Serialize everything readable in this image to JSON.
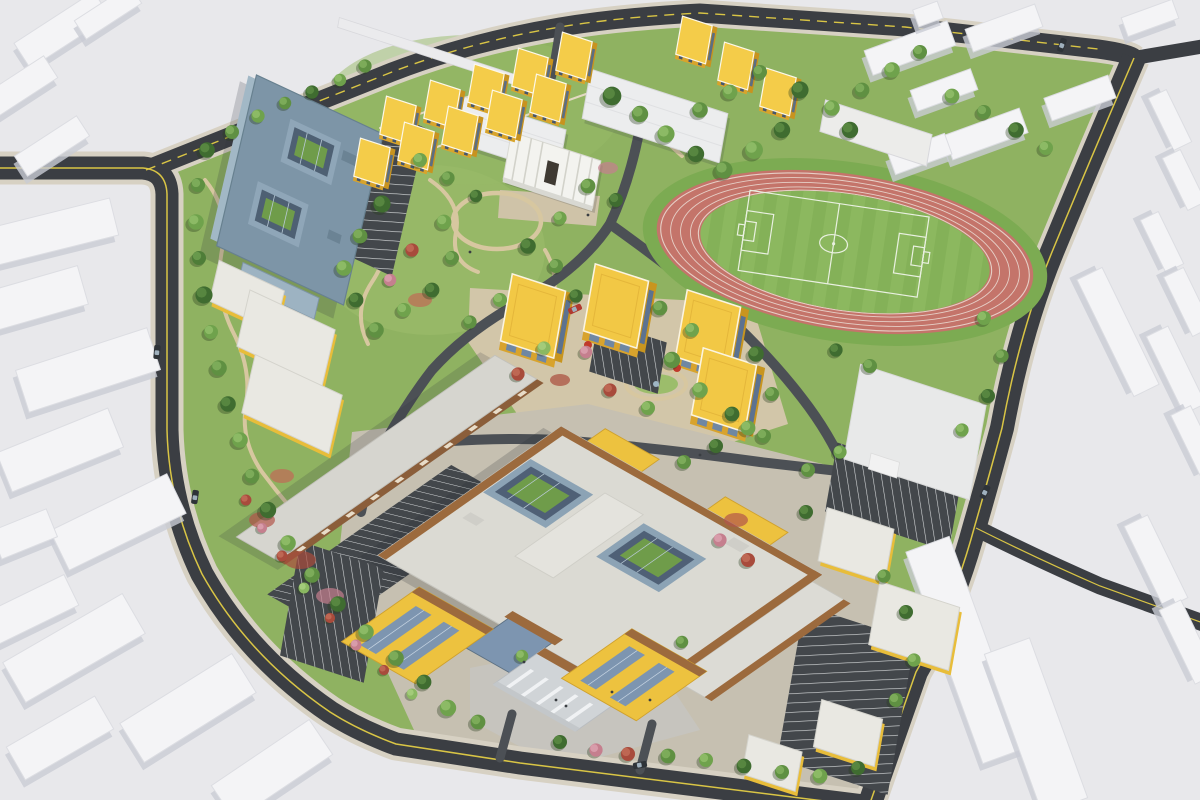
{
  "palette": {
    "background": "#e8e8eb",
    "context_building": "#f4f4f6",
    "context_shadow": "#c9ccd4",
    "context_stroke": "#dcdde2",
    "road": "#3b3e43",
    "road_inner": "#4c5055",
    "sidewalk": "#d7d1c3",
    "lane_yellow": "#d9c545",
    "stripe_white": "#dadde0",
    "campus_lawn": "#8fb261",
    "lawn_light": "#9cbd6b",
    "paving_tan": "#d2c6a9",
    "paving_gray": "#c6c0b1",
    "garden_path": "#d7c7a0",
    "track_surface": "#c4746a",
    "track_line": "#ecdfd7",
    "field_green": "#84b158",
    "field_stripe": "#93bf66",
    "field_line": "#e9f0e0",
    "asphalt": "#43474b",
    "dorm_roof": "#f4cc49",
    "dorm_side": "#d8a42c",
    "dorm_window": "#46566b",
    "cube_roof": "#f2c845",
    "glass_blue": "#7d95b0",
    "glass_dark": "#51637a",
    "blue_roof": "#7d95a7",
    "blue_roof_edge": "#67808f",
    "main_roof": "#dbdad3",
    "wood_trim": "#9c6a3d",
    "yellow_wall": "#edc23f",
    "yellow_shadow": "#cfa12e",
    "stone": "#d0d4d7",
    "white_roof": "#ececea",
    "brown_facade": "#8b5e3a",
    "courtyard_lawn": "#6f9c4a",
    "car_dark": "#2e3338",
    "car_red": "#b03a30",
    "tree_greens": [
      "#4e7d38",
      "#5f9042",
      "#6fa24c",
      "#3f6c30"
    ],
    "shrub_red": "#a84b3c",
    "shrub_pink": "#c57f8e"
  },
  "scene": {
    "context_buildings": [
      [
        62,
        30,
        95,
        30,
        -33
      ],
      [
        18,
        88,
        78,
        26,
        -33
      ],
      [
        108,
        12,
        66,
        22,
        -33
      ],
      [
        52,
        146,
        74,
        24,
        -33
      ],
      [
        52,
        232,
        128,
        38,
        -14
      ],
      [
        30,
        300,
        110,
        40,
        -16
      ],
      [
        88,
        370,
        138,
        44,
        -18
      ],
      [
        60,
        450,
        120,
        42,
        -22
      ],
      [
        118,
        522,
        130,
        44,
        -26
      ],
      [
        24,
        534,
        60,
        30,
        -22
      ],
      [
        30,
        610,
        92,
        34,
        -26
      ],
      [
        74,
        648,
        138,
        46,
        -30
      ],
      [
        188,
        708,
        132,
        46,
        -32
      ],
      [
        60,
        738,
        102,
        38,
        -30
      ],
      [
        272,
        770,
        118,
        42,
        -34
      ],
      [
        910,
        48,
        88,
        26,
        -20
      ],
      [
        1004,
        28,
        74,
        24,
        -20
      ],
      [
        944,
        90,
        64,
        22,
        -20
      ],
      [
        1080,
        98,
        68,
        24,
        -20
      ],
      [
        986,
        134,
        80,
        26,
        -20
      ],
      [
        920,
        154,
        60,
        22,
        -20
      ],
      [
        1150,
        18,
        54,
        20,
        -20
      ],
      [
        928,
        14,
        26,
        18,
        -20
      ],
      [
        1170,
        120,
        58,
        20,
        64
      ],
      [
        1184,
        180,
        58,
        20,
        64
      ],
      [
        1162,
        242,
        58,
        20,
        64
      ],
      [
        1188,
        302,
        66,
        22,
        64
      ],
      [
        1176,
        370,
        86,
        24,
        64
      ],
      [
        1196,
        442,
        70,
        22,
        64
      ],
      [
        966,
        650,
        46,
        225,
        -20
      ],
      [
        1036,
        726,
        48,
        170,
        -20
      ],
      [
        1118,
        332,
        130,
        28,
        64
      ],
      [
        1156,
        562,
        92,
        26,
        64
      ],
      [
        1188,
        642,
        82,
        24,
        64
      ]
    ],
    "dorm_cubes": [
      [
        398,
        120
      ],
      [
        442,
        104
      ],
      [
        486,
        88
      ],
      [
        530,
        72
      ],
      [
        574,
        56
      ],
      [
        372,
        162
      ],
      [
        416,
        146
      ],
      [
        460,
        130
      ],
      [
        504,
        114
      ],
      [
        548,
        98
      ],
      [
        694,
        40
      ],
      [
        736,
        66
      ],
      [
        778,
        92
      ]
    ],
    "teaching_cubes": [
      [
        533,
        316
      ],
      [
        616,
        306
      ],
      [
        708,
        332
      ],
      [
        724,
        390
      ]
    ],
    "trees": [
      [
        207,
        150,
        1,
        3
      ],
      [
        198,
        185,
        0.9,
        1
      ],
      [
        196,
        222,
        1,
        2
      ],
      [
        199,
        258,
        0.9,
        0
      ],
      [
        204,
        295,
        1.1,
        3
      ],
      [
        211,
        332,
        0.9,
        2
      ],
      [
        219,
        368,
        1,
        1
      ],
      [
        228,
        404,
        1,
        3
      ],
      [
        240,
        440,
        1,
        2
      ],
      [
        252,
        476,
        0.95,
        1
      ],
      [
        268,
        510,
        1.05,
        3
      ],
      [
        288,
        543,
        1,
        2
      ],
      [
        312,
        575,
        1,
        1
      ],
      [
        338,
        604,
        1,
        3
      ],
      [
        366,
        632,
        1,
        2
      ],
      [
        396,
        658,
        1,
        1
      ],
      [
        424,
        682,
        0.95,
        3
      ],
      [
        246,
        500,
        0.7,
        4
      ],
      [
        262,
        528,
        0.65,
        5
      ],
      [
        282,
        556,
        0.7,
        4
      ],
      [
        304,
        588,
        0.7,
        6
      ],
      [
        330,
        618,
        0.65,
        4
      ],
      [
        356,
        645,
        0.7,
        5
      ],
      [
        384,
        670,
        0.65,
        4
      ],
      [
        412,
        694,
        0.7,
        6
      ],
      [
        232,
        132,
        0.9,
        1
      ],
      [
        258,
        116,
        0.85,
        2
      ],
      [
        285,
        103,
        0.8,
        1
      ],
      [
        312,
        92,
        0.85,
        3
      ],
      [
        340,
        80,
        0.8,
        2
      ],
      [
        365,
        66,
        0.85,
        1
      ],
      [
        420,
        160,
        0.9,
        2
      ],
      [
        448,
        178,
        0.85,
        1
      ],
      [
        476,
        196,
        0.8,
        3
      ],
      [
        588,
        186,
        0.95,
        1
      ],
      [
        616,
        200,
        0.9,
        3
      ],
      [
        560,
        218,
        0.85,
        2
      ],
      [
        612,
        96,
        1.2,
        3
      ],
      [
        640,
        114,
        1.05,
        1
      ],
      [
        666,
        134,
        1.1,
        2
      ],
      [
        696,
        154,
        1.05,
        3
      ],
      [
        724,
        170,
        1.1,
        1
      ],
      [
        754,
        150,
        1.15,
        2
      ],
      [
        782,
        130,
        1.05,
        3
      ],
      [
        700,
        110,
        1,
        1
      ],
      [
        730,
        92,
        0.95,
        2
      ],
      [
        760,
        72,
        0.9,
        1
      ],
      [
        800,
        90,
        1.1,
        3
      ],
      [
        832,
        108,
        1,
        2
      ],
      [
        862,
        90,
        0.95,
        1
      ],
      [
        892,
        70,
        1,
        2
      ],
      [
        920,
        52,
        0.9,
        1
      ],
      [
        850,
        130,
        1.05,
        3
      ],
      [
        952,
        96,
        0.95,
        2
      ],
      [
        984,
        112,
        0.9,
        1
      ],
      [
        1016,
        130,
        1,
        3
      ],
      [
        1046,
        148,
        0.9,
        2
      ],
      [
        672,
        360,
        1.05,
        1
      ],
      [
        700,
        390,
        1,
        2
      ],
      [
        732,
        414,
        0.95,
        3
      ],
      [
        764,
        436,
        0.9,
        1
      ],
      [
        984,
        318,
        0.9,
        2
      ],
      [
        1002,
        356,
        0.85,
        1
      ],
      [
        988,
        396,
        0.9,
        3
      ],
      [
        962,
        430,
        0.85,
        2
      ],
      [
        870,
        366,
        0.9,
        1
      ],
      [
        836,
        350,
        0.85,
        3
      ],
      [
        382,
        204,
        1.1,
        3
      ],
      [
        360,
        236,
        0.95,
        1
      ],
      [
        344,
        268,
        1,
        2
      ],
      [
        356,
        300,
        0.95,
        3
      ],
      [
        376,
        330,
        1,
        1
      ],
      [
        404,
        310,
        0.9,
        2
      ],
      [
        432,
        290,
        0.95,
        3
      ],
      [
        452,
        258,
        0.9,
        1
      ],
      [
        444,
        222,
        0.95,
        2
      ],
      [
        412,
        250,
        0.85,
        4
      ],
      [
        390,
        280,
        0.8,
        5
      ],
      [
        528,
        246,
        1,
        3
      ],
      [
        556,
        266,
        0.9,
        1
      ],
      [
        500,
        300,
        0.9,
        2
      ],
      [
        470,
        322,
        0.85,
        1
      ],
      [
        576,
        296,
        0.85,
        3
      ],
      [
        660,
        308,
        0.95,
        1
      ],
      [
        692,
        330,
        0.9,
        2
      ],
      [
        756,
        354,
        1,
        3
      ],
      [
        772,
        394,
        0.9,
        1
      ],
      [
        748,
        428,
        0.95,
        2
      ],
      [
        716,
        446,
        0.9,
        3
      ],
      [
        684,
        462,
        0.9,
        1
      ],
      [
        648,
        408,
        0.9,
        2
      ],
      [
        610,
        390,
        0.85,
        4
      ],
      [
        586,
        352,
        0.8,
        5
      ],
      [
        544,
        348,
        0.85,
        6
      ],
      [
        518,
        374,
        0.85,
        4
      ],
      [
        808,
        470,
        0.9,
        1
      ],
      [
        840,
        452,
        0.85,
        2
      ],
      [
        806,
        512,
        0.9,
        3
      ],
      [
        448,
        708,
        1.05,
        2
      ],
      [
        478,
        722,
        0.95,
        1
      ],
      [
        560,
        742,
        0.9,
        3
      ],
      [
        596,
        750,
        0.85,
        5
      ],
      [
        628,
        754,
        0.9,
        4
      ],
      [
        668,
        756,
        0.95,
        1
      ],
      [
        706,
        760,
        0.9,
        2
      ],
      [
        744,
        766,
        0.95,
        3
      ],
      [
        782,
        772,
        0.9,
        1
      ],
      [
        820,
        776,
        0.95,
        2
      ],
      [
        858,
        768,
        0.9,
        3
      ],
      [
        896,
        700,
        0.9,
        1
      ],
      [
        914,
        660,
        0.85,
        2
      ],
      [
        906,
        612,
        0.9,
        3
      ],
      [
        884,
        576,
        0.85,
        1
      ],
      [
        748,
        560,
        0.9,
        4
      ],
      [
        720,
        540,
        0.85,
        5
      ],
      [
        522,
        656,
        0.8,
        2
      ],
      [
        682,
        642,
        0.8,
        1
      ]
    ],
    "flower_beds": [
      [
        300,
        560,
        16,
        9,
        "#a84b3c"
      ],
      [
        330,
        596,
        14,
        8,
        "#c57f8e"
      ],
      [
        262,
        520,
        13,
        8,
        "#b2564a"
      ],
      [
        420,
        300,
        12,
        7,
        "#c06a55"
      ],
      [
        560,
        380,
        10,
        6,
        "#a84b3c"
      ],
      [
        736,
        520,
        12,
        7,
        "#b2564a"
      ],
      [
        608,
        168,
        10,
        6,
        "#c57f8e"
      ],
      [
        282,
        476,
        12,
        7,
        "#c06a55"
      ]
    ],
    "sculptures": [
      [
        588,
        345
      ],
      [
        677,
        368
      ]
    ],
    "cars": [
      [
        195,
        497,
        -82,
        "dark"
      ],
      [
        157,
        352,
        -85,
        "dark"
      ],
      [
        985,
        492,
        -63,
        "dark"
      ],
      [
        1062,
        45,
        -70,
        "dark"
      ],
      [
        575,
        309,
        -25,
        "red"
      ],
      [
        640,
        765,
        -10,
        "dark"
      ]
    ],
    "people": [
      [
        556,
        700
      ],
      [
        566,
        706
      ],
      [
        612,
        692
      ],
      [
        524,
        662
      ],
      [
        650,
        700
      ],
      [
        470,
        252
      ],
      [
        588,
        215
      ],
      [
        700,
        455
      ]
    ]
  }
}
